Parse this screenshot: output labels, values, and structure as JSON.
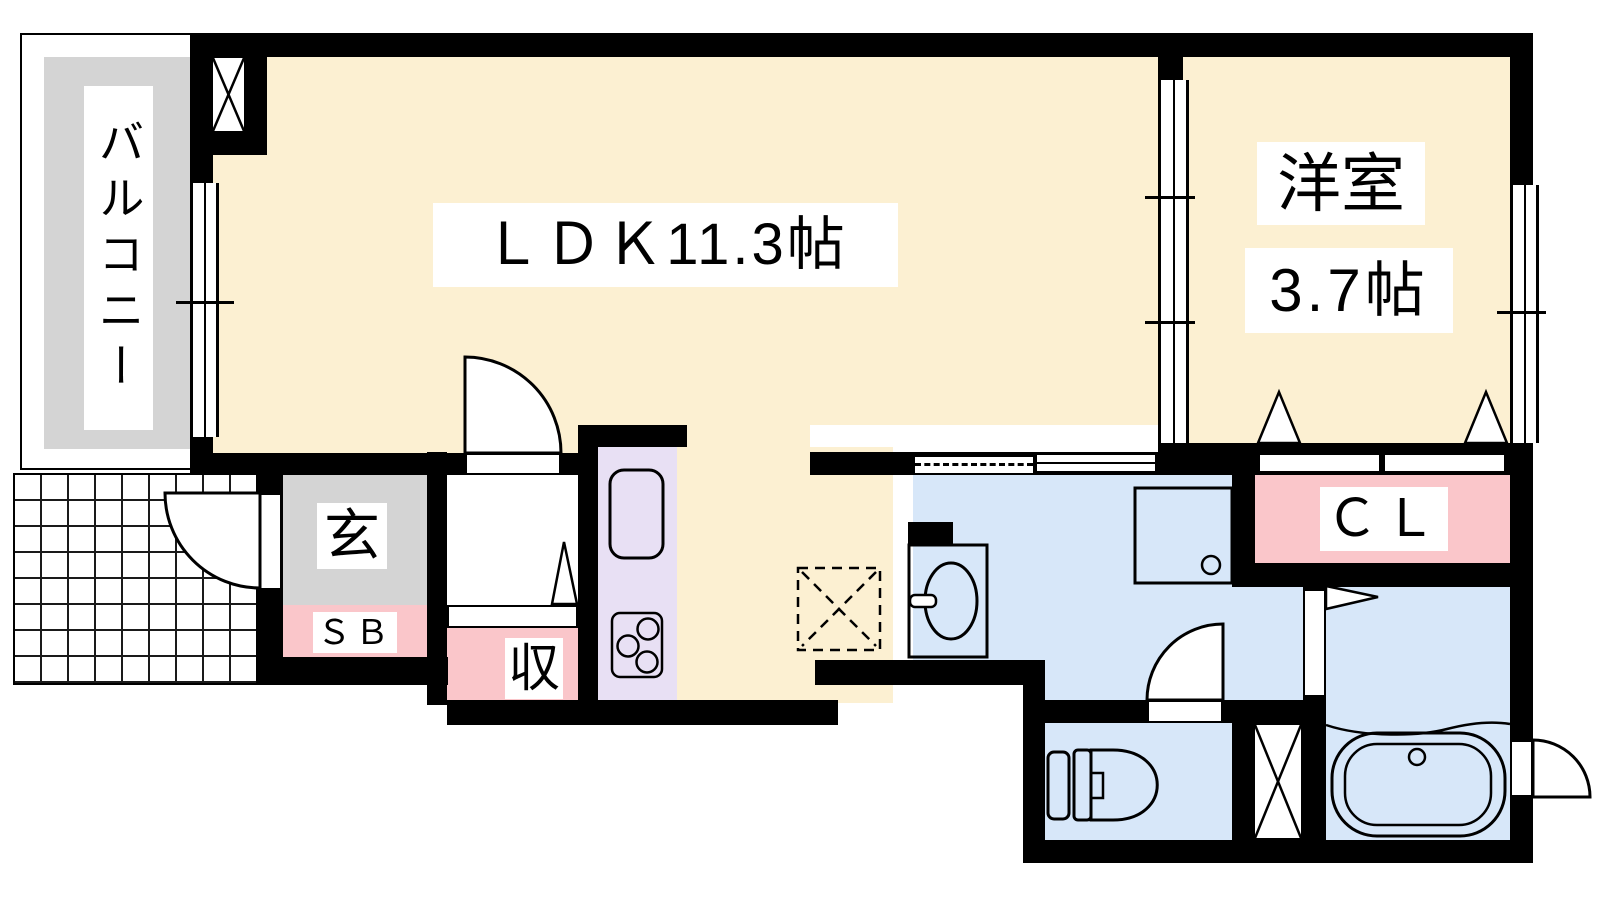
{
  "plan_title": "1LDK apartment floor plan",
  "rooms": {
    "balcony": {
      "label": "バルコニー"
    },
    "ldk": {
      "label": "ＬＤＫ11.3帖"
    },
    "western_room": {
      "label": "洋室",
      "size": "3.7帖"
    },
    "entrance": {
      "label": "玄"
    },
    "shoe_box": {
      "label": "ＳＢ"
    },
    "storage": {
      "label": "収"
    },
    "closet": {
      "label": "ＣＬ"
    }
  },
  "colors": {
    "room_floor": "#FCF0D2",
    "balcony_entrance_floor": "#D4D4D4",
    "storage_closet": "#FAC6CA",
    "kitchen_counter": "#E8E0F4",
    "water_area": "#D7E7F9",
    "walls": "#000000"
  }
}
